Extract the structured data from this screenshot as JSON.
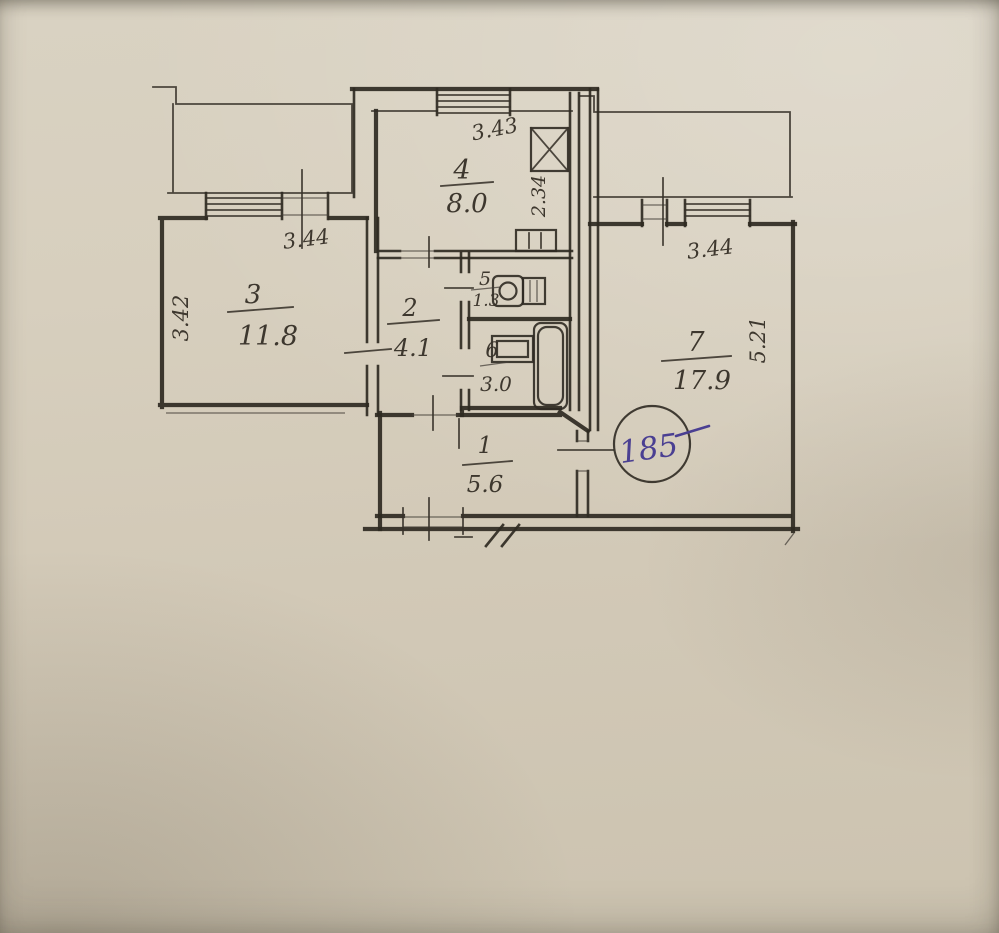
{
  "plan": {
    "rooms": [
      {
        "number": "1",
        "area": "5.6"
      },
      {
        "number": "2",
        "area": "4.1"
      },
      {
        "number": "3",
        "area": "11.8"
      },
      {
        "number": "4",
        "area": "8.0"
      },
      {
        "number": "5",
        "area": "1.3"
      },
      {
        "number": "6",
        "area": "3.0"
      },
      {
        "number": "7",
        "area": "17.9"
      }
    ],
    "dims": [
      {
        "value": "3.44",
        "edge": "room3-top"
      },
      {
        "value": "3.42",
        "edge": "room3-left"
      },
      {
        "value": "3.43",
        "edge": "kitchen-top"
      },
      {
        "value": "2.34",
        "edge": "kitchen-right"
      },
      {
        "value": "3.44",
        "edge": "room7-top"
      },
      {
        "value": "5.21",
        "edge": "room7-right"
      }
    ],
    "apartment_stamp": {
      "value": "185"
    },
    "icons": [
      "toilet-icon",
      "sink-icon",
      "bathtub-icon",
      "stove-icon",
      "vent-shaft-icon",
      "window-symbol",
      "door-opening-tick"
    ],
    "colors": {
      "paper": "#d2c9b7",
      "ink": "#2f2a22",
      "pen_ink": "#4a3f92"
    }
  }
}
